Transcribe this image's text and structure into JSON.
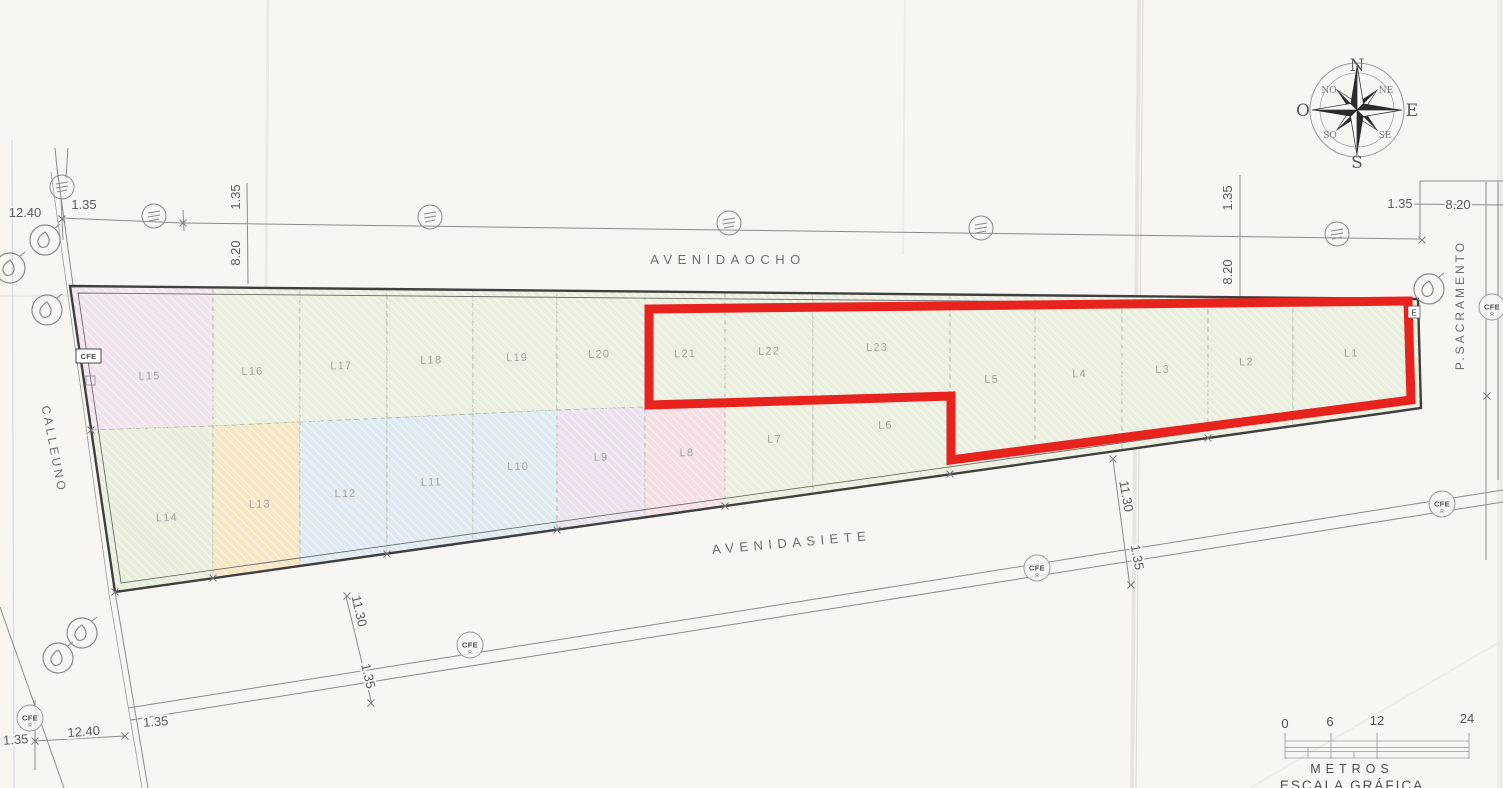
{
  "plan": {
    "streets": {
      "north": "AVENIDAOCHO",
      "south": "AVENIDASIETE",
      "west": "CALLEUNO",
      "east": "P.SACRAMENTO"
    },
    "lots": [
      {
        "label": "L15",
        "color": "#f1e3eb",
        "highlighted": false
      },
      {
        "label": "L16",
        "color": "#eaeede",
        "highlighted": false
      },
      {
        "label": "L17",
        "color": "#eaeede",
        "highlighted": false
      },
      {
        "label": "L18",
        "color": "#eaeede",
        "highlighted": false
      },
      {
        "label": "L19",
        "color": "#eaeede",
        "highlighted": false
      },
      {
        "label": "L20",
        "color": "#eaeede",
        "highlighted": false
      },
      {
        "label": "L21",
        "color": "#eaeede",
        "highlighted": true
      },
      {
        "label": "L22",
        "color": "#eaeede",
        "highlighted": true
      },
      {
        "label": "L23",
        "color": "#eaeede",
        "highlighted": true
      },
      {
        "label": "L5",
        "color": "#eaeede",
        "highlighted": true
      },
      {
        "label": "L4",
        "color": "#eaeede",
        "highlighted": true
      },
      {
        "label": "L3",
        "color": "#eaeede",
        "highlighted": true
      },
      {
        "label": "L2",
        "color": "#eaeede",
        "highlighted": true
      },
      {
        "label": "L1",
        "color": "#eaeede",
        "highlighted": true
      },
      {
        "label": "L14",
        "color": "#e6eddb",
        "highlighted": false
      },
      {
        "label": "L13",
        "color": "#f6e6c4",
        "highlighted": false
      },
      {
        "label": "L12",
        "color": "#dfe9f2",
        "highlighted": false
      },
      {
        "label": "L11",
        "color": "#dfe9f2",
        "highlighted": false
      },
      {
        "label": "L10",
        "color": "#dfe9f2",
        "highlighted": false
      },
      {
        "label": "L9",
        "color": "#ebe0ee",
        "highlighted": false
      },
      {
        "label": "L8",
        "color": "#f5dfe3",
        "highlighted": false
      },
      {
        "label": "L7",
        "color": "#eaeede",
        "highlighted": false
      },
      {
        "label": "L6",
        "color": "#eaeede",
        "highlighted": false
      }
    ],
    "highlight_color": "#e8221d",
    "corner_point_label": "E"
  },
  "dimensions": {
    "v1240": "12.40",
    "v135": "1.35",
    "v820": "8.20",
    "v1130": "11.30"
  },
  "utility": {
    "cfe": "CFE"
  },
  "compass": {
    "n": "N",
    "ne": "NE",
    "e": "E",
    "se": "SE",
    "s": "S",
    "so": "SO",
    "o": "O",
    "no": "NO"
  },
  "scale_bar": {
    "ticks": [
      "0",
      "6",
      "12",
      "24"
    ],
    "units": "METROS",
    "caption": "ESCALA GRÁFICA"
  }
}
